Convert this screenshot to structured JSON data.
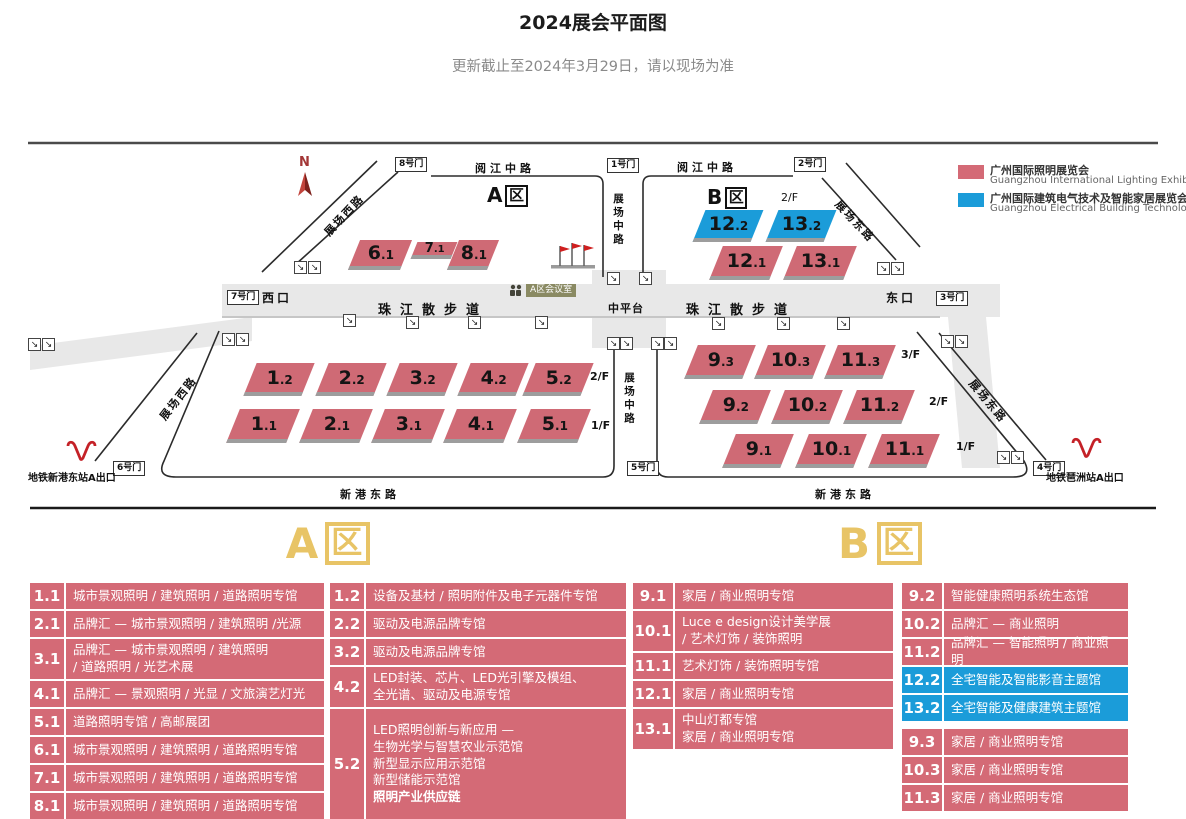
{
  "page": {
    "title": "2024展会平面图",
    "subtitle": "更新截止至2024年3月29日，请以现场为准"
  },
  "legend": {
    "items": [
      {
        "color": "#d46a76",
        "zh": "广州国际照明展览会",
        "en": "Guangzhou International Lighting Exhibition"
      },
      {
        "color": "#1b9cd9",
        "zh": "广州国际建筑电气技术及智能家居展览会",
        "en": "Guangzhou Electrical Building Technology"
      }
    ]
  },
  "map": {
    "compass": "N",
    "zone_a": "A",
    "zone_b": "B",
    "zone_char": "区",
    "gates": {
      "g1": "1号门",
      "g2": "2号门",
      "g3": "3号门",
      "g4": "4号门",
      "g5": "5号门",
      "g6": "6号门",
      "g7": "7号门",
      "g8": "8号门"
    },
    "roads": {
      "yuejiang": "阅江中路",
      "west": "展场西路",
      "middle": "展场中路",
      "east": "展场东路",
      "xingang": "新港东路"
    },
    "walkway": {
      "pearl": "珠江散步道",
      "west_exit": "西口",
      "east_exit": "东口",
      "platform": "中平台",
      "meeting_room": "A区会议室"
    },
    "floors": {
      "f1": "1/F",
      "f2": "2/F",
      "f3": "3/F"
    },
    "metro": {
      "west": "地铁新港东站A出口",
      "east": "地铁琶洲站A出口"
    },
    "halls": {
      "a_upper": [
        "6.1",
        "7.1",
        "8.1"
      ],
      "b_upper": [
        "12.2",
        "13.2",
        "12.1",
        "13.1"
      ],
      "a_lower_2f": [
        "1.2",
        "2.2",
        "3.2",
        "4.2",
        "5.2"
      ],
      "a_lower_1f": [
        "1.1",
        "2.1",
        "3.1",
        "4.1",
        "5.1"
      ],
      "b_lower_3f": [
        "9.3",
        "10.3",
        "11.3"
      ],
      "b_lower_2f": [
        "9.2",
        "10.2",
        "11.2"
      ],
      "b_lower_1f": [
        "9.1",
        "10.1",
        "11.1"
      ]
    }
  },
  "tables": {
    "a_letter": "A",
    "b_letter": "B",
    "zone_char": "区",
    "a_left": [
      {
        "hall": "1.1",
        "desc": "城市景观照明 / 建筑照明 / 道路照明专馆"
      },
      {
        "hall": "2.1",
        "desc": "品牌汇 — 城市景观照明 / 建筑照明 /光源"
      },
      {
        "hall": "3.1",
        "desc": "品牌汇 — 城市景观照明 / 建筑照明\n/ 道路照明 / 光艺术展"
      },
      {
        "hall": "4.1",
        "desc": "品牌汇 — 景观照明 / 光显 / 文旅演艺灯光"
      },
      {
        "hall": "5.1",
        "desc": "道路照明专馆 / 高邮展团"
      },
      {
        "hall": "6.1",
        "desc": "城市景观照明 / 建筑照明 / 道路照明专馆"
      },
      {
        "hall": "7.1",
        "desc": "城市景观照明 / 建筑照明 / 道路照明专馆"
      },
      {
        "hall": "8.1",
        "desc": "城市景观照明 / 建筑照明 / 道路照明专馆"
      }
    ],
    "a_right": [
      {
        "hall": "1.2",
        "desc": "设备及基材 / 照明附件及电子元器件专馆"
      },
      {
        "hall": "2.2",
        "desc": "驱动及电源品牌专馆"
      },
      {
        "hall": "3.2",
        "desc": "驱动及电源品牌专馆"
      },
      {
        "hall": "4.2",
        "desc": "LED封装、芯片、LED光引擎及模组、\n全光谱、驱动及电源专馆"
      },
      {
        "hall": "5.2",
        "desc": "LED照明创新与新应用 —\n生物光学与智慧农业示范馆\n新型显示应用示范馆\n新型储能示范馆",
        "bold": "照明产业供应链"
      }
    ],
    "b_left": [
      {
        "hall": "9.1",
        "desc": "家居 / 商业照明专馆"
      },
      {
        "hall": "10.1",
        "desc": "Luce e design设计美学展\n/ 艺术灯饰 / 装饰照明"
      },
      {
        "hall": "11.1",
        "desc": "艺术灯饰 / 装饰照明专馆"
      },
      {
        "hall": "12.1",
        "desc": "家居 / 商业照明专馆"
      },
      {
        "hall": "13.1",
        "desc": "中山灯都专馆\n家居 / 商业照明专馆"
      }
    ],
    "b_right_upper": [
      {
        "hall": "9.2",
        "desc": "智能健康照明系统生态馆"
      },
      {
        "hall": "10.2",
        "desc": "品牌汇 — 商业照明"
      },
      {
        "hall": "11.2",
        "desc": "品牌汇 — 智能照明 / 商业照明"
      },
      {
        "hall": "12.2",
        "desc": "全宅智能及智能影音主题馆"
      },
      {
        "hall": "13.2",
        "desc": "全宅智能及健康建筑主题馆"
      }
    ],
    "b_right_lower": [
      {
        "hall": "9.3",
        "desc": "家居 / 商业照明专馆"
      },
      {
        "hall": "10.3",
        "desc": "家居 / 商业照明专馆"
      },
      {
        "hall": "11.3",
        "desc": "家居 / 商业照明专馆"
      }
    ]
  }
}
